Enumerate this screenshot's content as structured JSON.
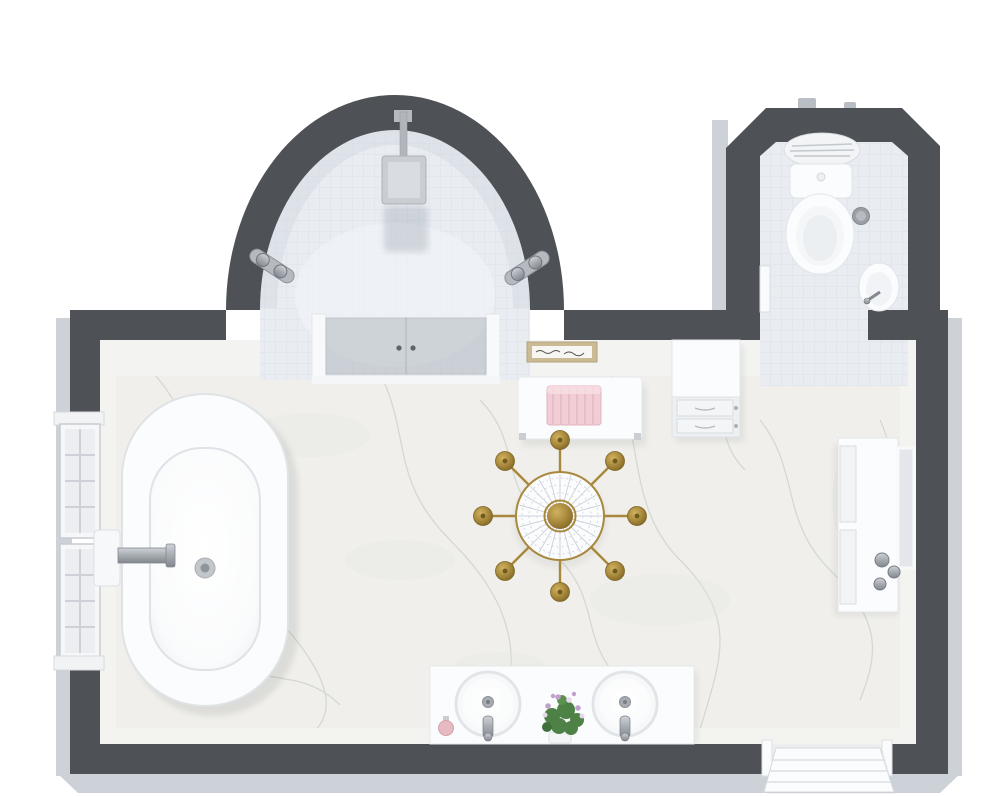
{
  "scene": {
    "label": "3D bathroom floor plan, top-down view"
  },
  "rooms": {
    "main": {
      "label": "Main bathroom"
    },
    "shower": {
      "label": "Curved shower alcove"
    },
    "wc": {
      "label": "Water closet"
    }
  },
  "fixtures": {
    "bathtub": {
      "label": "Freestanding bathtub"
    },
    "tub_filler": {
      "label": "Wall-mounted tub filler"
    },
    "window_upper": {
      "label": "Paned window"
    },
    "window_lower": {
      "label": "Paned window"
    },
    "shower_head": {
      "label": "Rain shower head"
    },
    "shower_glass": {
      "label": "Glass shower doors"
    },
    "shower_control_left": {
      "label": "Shower control bar"
    },
    "shower_control_right": {
      "label": "Shower control bar"
    },
    "toilet": {
      "label": "Toilet"
    },
    "wc_basin": {
      "label": "Corner hand basin"
    },
    "wc_bin": {
      "label": "Waste bin"
    },
    "wc_door": {
      "label": "Water closet door"
    },
    "bench": {
      "label": "Bench"
    },
    "towel": {
      "label": "Folded pink towel"
    },
    "wall_art": {
      "label": "Framed wall art"
    },
    "dresser": {
      "label": "Drawer cabinet"
    },
    "chandelier": {
      "label": "Crystal chandelier"
    },
    "vanity": {
      "label": "Double sink vanity"
    },
    "sink_left": {
      "label": "Round vessel sink"
    },
    "sink_right": {
      "label": "Round vessel sink"
    },
    "faucet_left": {
      "label": "Chrome faucet"
    },
    "faucet_right": {
      "label": "Chrome faucet"
    },
    "bouquet": {
      "label": "Flower bouquet"
    },
    "soap": {
      "label": "Soap dispenser"
    },
    "cabinet": {
      "label": "Storage cabinet"
    },
    "mirror": {
      "label": "Framed mirror"
    },
    "entry_door": {
      "label": "Entry door (open)"
    }
  },
  "colors": {
    "background": "#ffffff",
    "wall": "#4e5256",
    "wall_edge": "#cdd1d8",
    "wall_tab": "#b9bec5",
    "inner_face": "#f3f4f1",
    "floor_marble": "#f0efeb",
    "marble_vein": "#b7c3bb",
    "tile": "#e9edf2",
    "tile_line": "#dce1e9",
    "porcelain": "#fbfcfd",
    "porcelain_shadow": "#e3e6ea",
    "glass": "#b4bac1",
    "chrome": "#a6abb1",
    "chrome_dark": "#82888e",
    "gold": "#a8883c",
    "gold_deep": "#7d6524",
    "crystal": "#eef0f5",
    "crystal_line": "#c6cbd7",
    "towel_pink": "#f1ced6",
    "towel_stripe": "#e2b5c0",
    "art_frame": "#cbbb95",
    "plant_green": "#4e8146",
    "flower_purple": "#c0a0cc",
    "soap_pink": "#e7b9c0",
    "shadow": "#2f3438"
  }
}
